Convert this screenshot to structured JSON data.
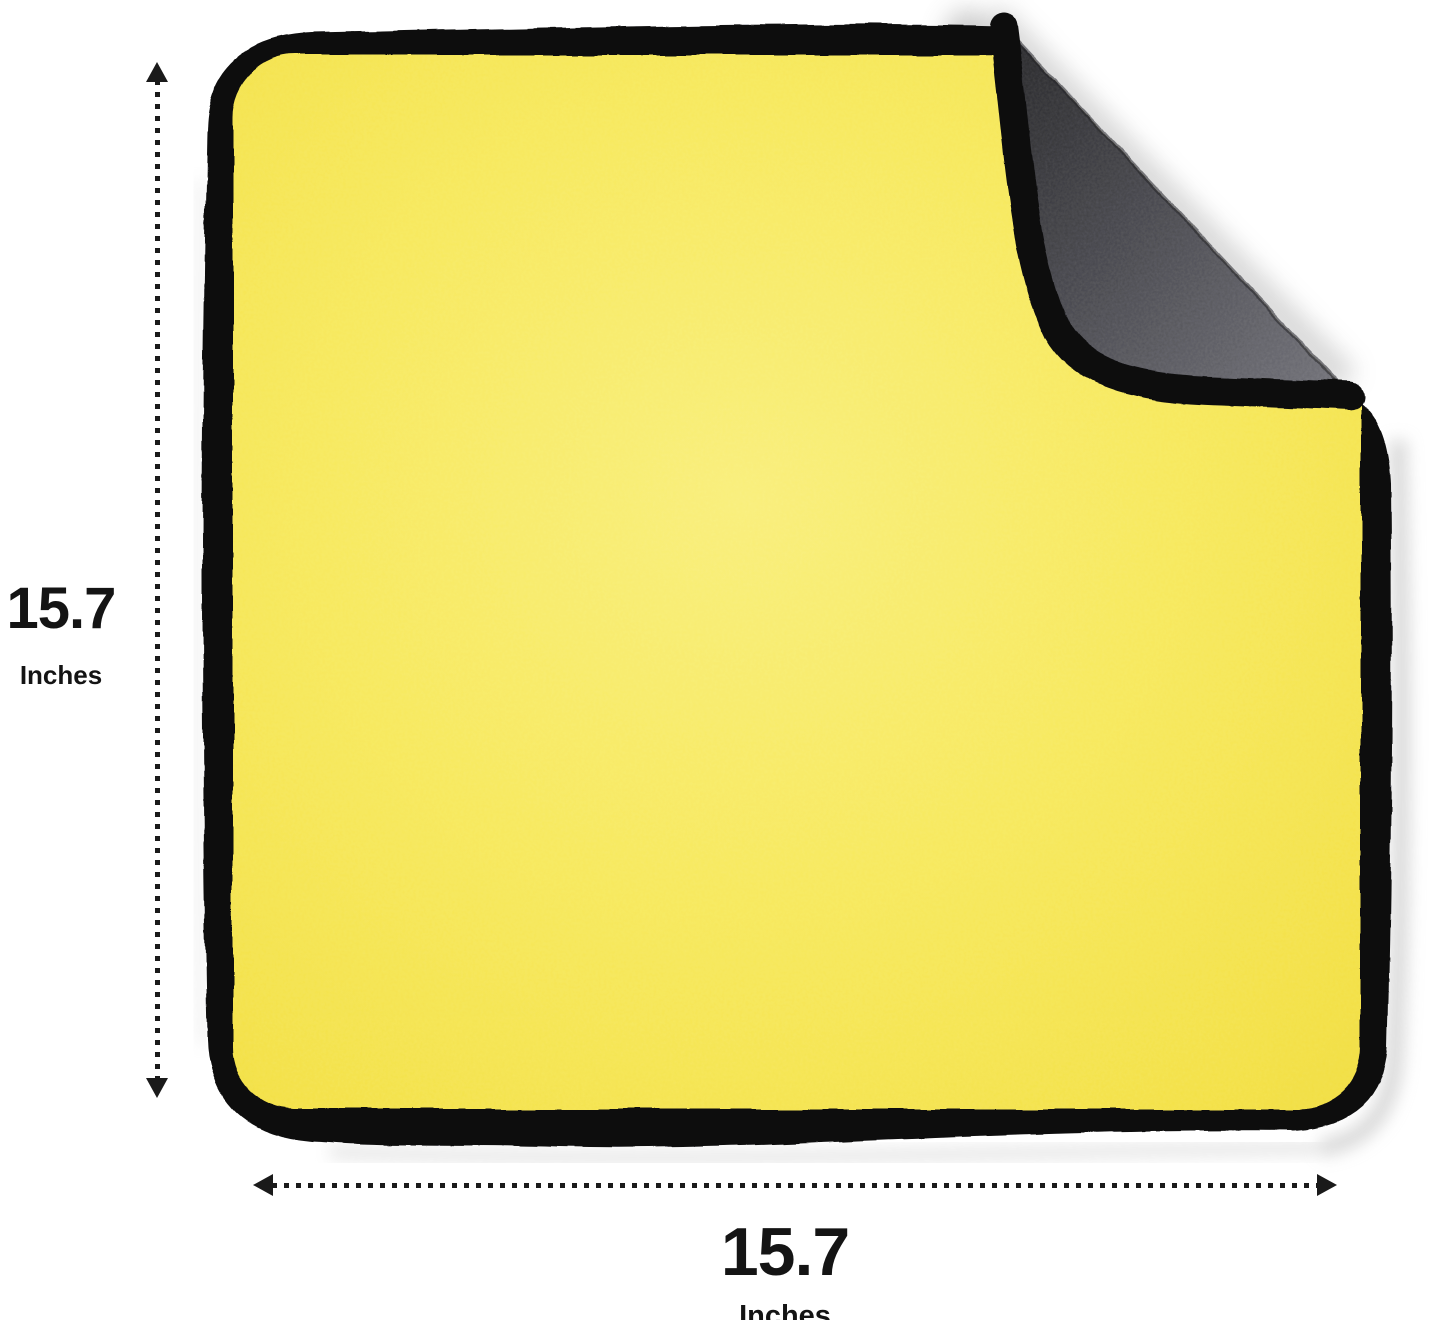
{
  "figure": {
    "subject": "two-tone microfiber cloth with folded corner",
    "front_color": "#f5e64e",
    "front_highlight_color": "#f9ef7a",
    "back_color": "#4b4b51",
    "back_dark_color": "#2a2a2d",
    "back_light_color": "#6e6e75",
    "trim_color": "#0e0e10",
    "background_color": "#ffffff",
    "shadow_color": "#b5b5b5"
  },
  "dimensions": {
    "vertical": {
      "value": "15.7",
      "unit": "Inches"
    },
    "horizontal": {
      "value": "15.7",
      "unit": "Inches"
    }
  },
  "annotation": {
    "arrow_color": "#1a1a1a",
    "text_color": "#141414",
    "icons": [
      "arrow-up-icon",
      "arrow-down-icon",
      "arrow-left-icon",
      "arrow-right-icon",
      "vertical-dotted-line",
      "horizontal-dotted-line"
    ]
  }
}
